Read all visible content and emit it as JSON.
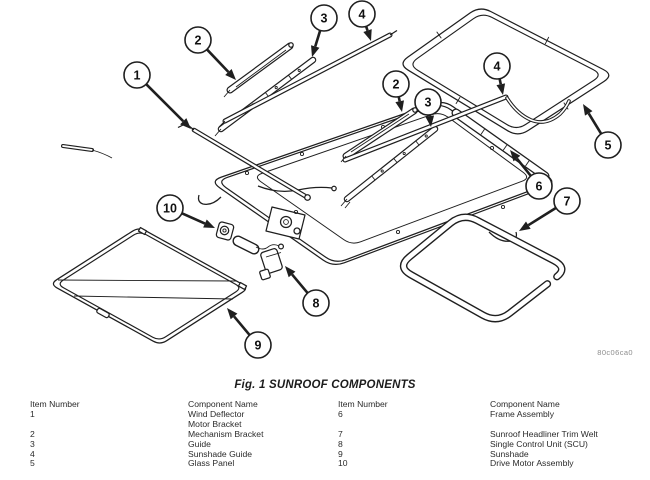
{
  "figure": {
    "caption": "Fig. 1 SUNROOF COMPONENTS",
    "watermark": "80c06ca0",
    "line_color": "#1f1f1f",
    "callouts": [
      {
        "num": "1",
        "cx": 137,
        "cy": 75,
        "tx": 191,
        "ty": 129
      },
      {
        "num": "2",
        "cx": 198,
        "cy": 40,
        "tx": 236,
        "ty": 80
      },
      {
        "num": "3",
        "cx": 324,
        "cy": 18,
        "tx": 312,
        "ty": 57
      },
      {
        "num": "4",
        "cx": 362,
        "cy": 14,
        "tx": 371,
        "ty": 41
      },
      {
        "num": "2",
        "cx": 396,
        "cy": 84,
        "tx": 402,
        "ty": 112
      },
      {
        "num": "3",
        "cx": 428,
        "cy": 102,
        "tx": 431,
        "ty": 127
      },
      {
        "num": "4",
        "cx": 497,
        "cy": 66,
        "tx": 503,
        "ty": 95
      },
      {
        "num": "5",
        "cx": 608,
        "cy": 145,
        "tx": 583,
        "ty": 104
      },
      {
        "num": "6",
        "cx": 539,
        "cy": 186,
        "tx": 510,
        "ty": 150
      },
      {
        "num": "7",
        "cx": 567,
        "cy": 201,
        "tx": 519,
        "ty": 231
      },
      {
        "num": "8",
        "cx": 316,
        "cy": 303,
        "tx": 285,
        "ty": 266
      },
      {
        "num": "9",
        "cx": 258,
        "cy": 345,
        "tx": 227,
        "ty": 308
      },
      {
        "num": "10",
        "cx": 170,
        "cy": 208,
        "tx": 215,
        "ty": 228
      }
    ]
  },
  "table": {
    "headers": [
      "Item Number",
      "Component Name",
      "Item Number",
      "Component Name"
    ],
    "rows": [
      [
        "1",
        "Wind Deflector\nMotor Bracket",
        "6",
        "Frame Assembly"
      ],
      [
        "2",
        "Mechanism Bracket",
        "7",
        "Sunroof Headliner Trim Welt"
      ],
      [
        "3",
        "Guide",
        "8",
        "Single Control Unit (SCU)"
      ],
      [
        "4",
        "Sunshade Guide",
        "9",
        "Sunshade"
      ],
      [
        "5",
        "Glass Panel",
        "10",
        "Drive Motor Assembly"
      ]
    ]
  }
}
